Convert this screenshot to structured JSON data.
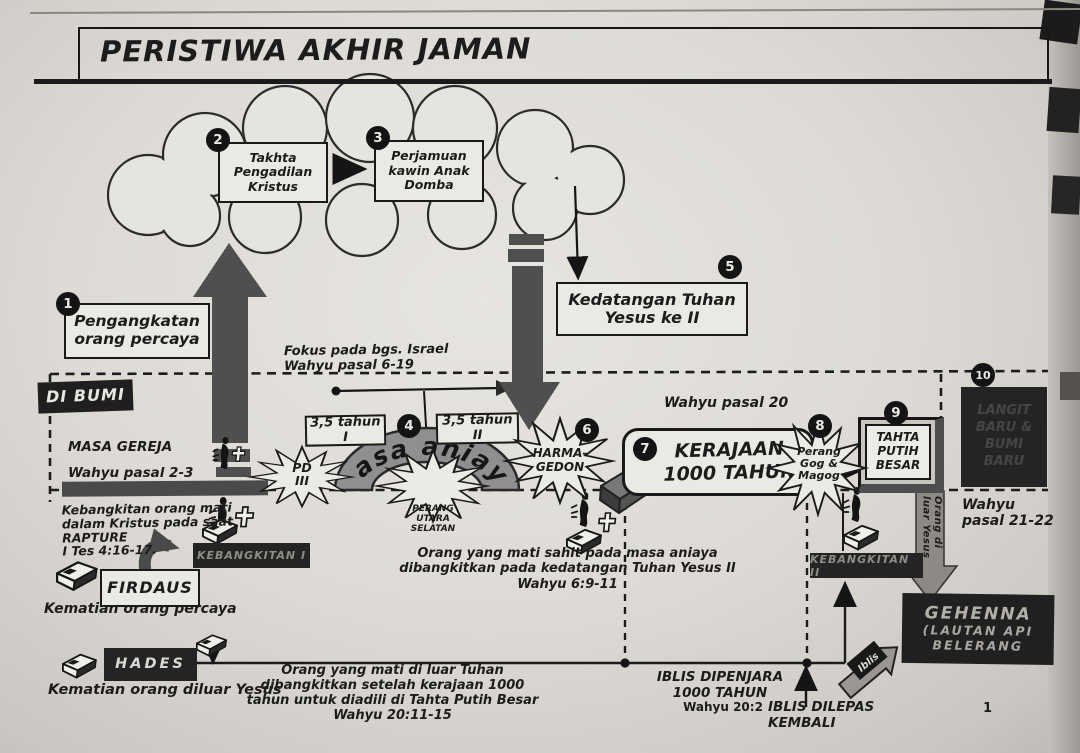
{
  "page": {
    "title": "PERISTIWA AKHIR JAMAN",
    "page_number": "1"
  },
  "colors": {
    "paper": "#dcd9d4",
    "ink": "#1c1c1c",
    "arrow_gray": "#4f4f4f",
    "arch_gray": "#8f8f8f",
    "black_panel": "#242424",
    "muted_label": "#908d87"
  },
  "sky": {
    "focus_note": "Fokus pada bgs. Israel\nWahyu pasal 6-19"
  },
  "cloud": {
    "judgment_seat": {
      "num": "2",
      "label": "Takhta\nPengadilan\nKristus"
    },
    "marriage_supper": {
      "num": "3",
      "label": "Perjamuan\nkawin Anak\nDomba"
    }
  },
  "rapture": {
    "num": "1",
    "label": "Pengangkatan\norang percaya"
  },
  "second_coming": {
    "num": "5",
    "label": "Kedatangan  Tuhan\nYesus ke II"
  },
  "earth": {
    "di_bumi": "DI BUMI",
    "masa_gereja": "MASA GEREJA",
    "ref": "Wahyu pasal 2-3"
  },
  "tribulation": {
    "num": "4",
    "period1": "3,5 tahun I",
    "period2": "3,5 tahun II",
    "arch_label": "masa aniaya",
    "pd3": "PD\nIII",
    "war": "PERANG\nUTARA\nSELATAN"
  },
  "armageddon": {
    "num": "6",
    "label": "HARMA-\nGEDON"
  },
  "kingdom": {
    "num": "7",
    "label": "KERAJAAN\n1000 TAHUN",
    "ref": "Wahyu pasal 20"
  },
  "gog": {
    "num": "8",
    "label": "Perang\nGog &\nMagog"
  },
  "throne": {
    "num": "9",
    "label": "TAHTA\nPUTIH\nBESAR"
  },
  "new_heaven": {
    "num": "10",
    "label": "LANGIT\nBARU &\nBUMI\nBARU",
    "ref": "Wahyu\npasal 21-22"
  },
  "resurrection1": {
    "note": "Kebangkitan orang mati\ndalam Kristus pada saat\nRAPTURE\nI Tes 4:16-17.",
    "bar": "KEBANGKITAN I",
    "firdaus": "FIRDAUS",
    "death_note": "Kematian orang percaya"
  },
  "martyrs": {
    "note": "Orang yang mati sahit pada masa aniaya\ndibangkitkan pada kedatangan Tuhan Yesus II\nWahyu 6:9-11"
  },
  "hades": {
    "label": "HADES",
    "death_note": "Kematian orang diluar Yesus",
    "note": "Orang yang mati di luar Tuhan\ndibangkitkan setelah kerajaan 1000\ntahun untuk diadili di Tahta Putih Besar\nWahyu 20:11-15"
  },
  "resurrection2": {
    "bar": "KEBANGKITAN II",
    "arrow_label": "Orang di luar Yesus"
  },
  "gehenna": {
    "line1": "GEHENNA",
    "line2": "(LAUTAN API",
    "line3": "BELERANG",
    "iblis": "Iblis"
  },
  "satan": {
    "imprisoned": "IBLIS DIPENJARA\n1000 TAHUN",
    "ref": "Wahyu 20:2",
    "released": "IBLIS DILEPAS\nKEMBALI"
  }
}
